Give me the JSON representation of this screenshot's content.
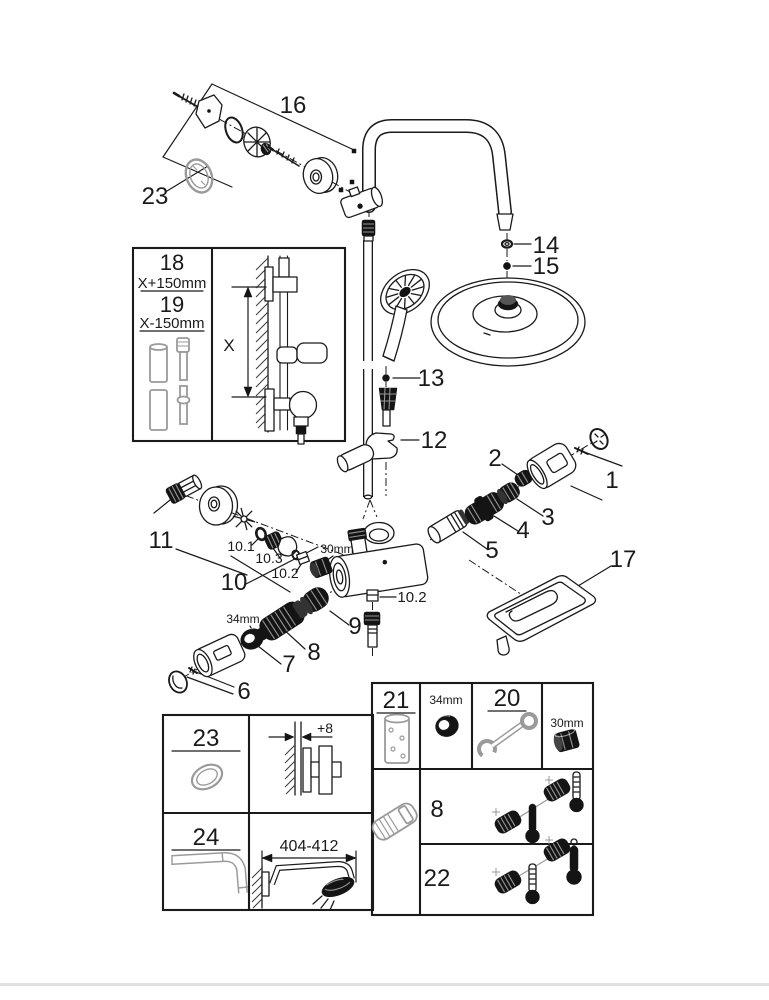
{
  "colors": {
    "line": "#1a1a1a",
    "gray": "#9a9a9a",
    "footer_bar": "#e0e0e0",
    "background": "#ffffff"
  },
  "parts": {
    "p1": "1",
    "p2": "2",
    "p3": "3",
    "p4": "4",
    "p5": "5",
    "p6": "6",
    "p7": "7",
    "p8": "8",
    "p9": "9",
    "p10": "10",
    "p11": "11",
    "p12": "12",
    "p13": "13",
    "p14": "14",
    "p15": "15",
    "p16": "16",
    "p17": "17",
    "p23": "23"
  },
  "sub_parts": {
    "p10_1": "10.1",
    "p10_2": "10.2",
    "p10_3": "10.3",
    "p10_2_outlet": "10.2"
  },
  "dimensions": {
    "nut_30mm": "30mm",
    "ring_34mm": "34mm"
  },
  "length_inset": {
    "p18": "18",
    "p18_dim": "X+150mm",
    "p19": "19",
    "p19_dim": "X-150mm",
    "axis_label": "X"
  },
  "accessory_box": {
    "p23": "23",
    "p24": "24",
    "wall_offset_dim": "+8",
    "arm_length_dim": "404-412"
  },
  "service_box": {
    "p21": "21",
    "p20": "20",
    "p8": "8",
    "p22": "22",
    "ring_dim": "34mm",
    "nut_dim": "30mm"
  }
}
